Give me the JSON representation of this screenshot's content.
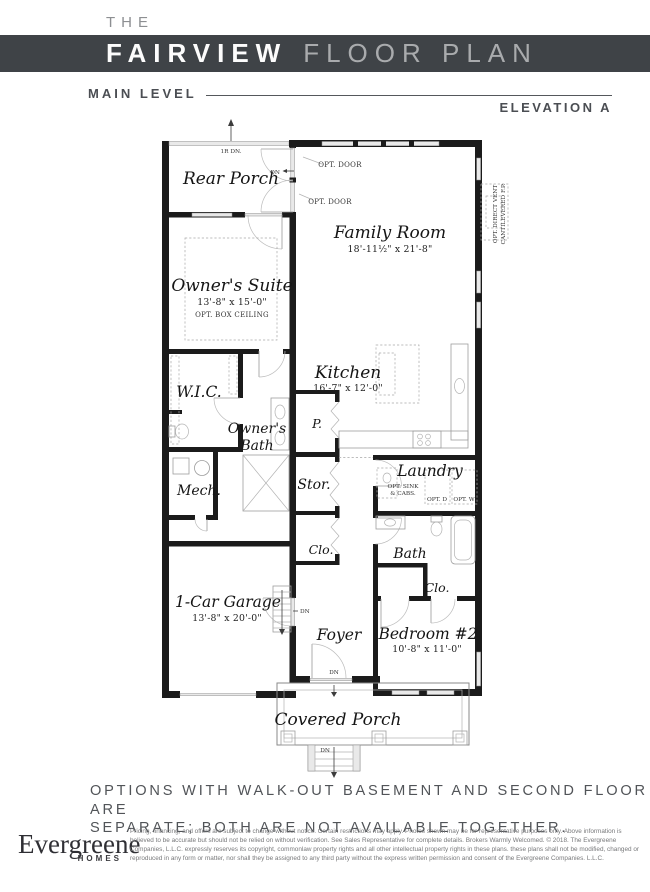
{
  "header": {
    "pre_title": "THE",
    "title": "FAIRVIEW",
    "title_suffix": "FLOOR PLAN",
    "level_label": "MAIN LEVEL",
    "elevation_label": "ELEVATION A"
  },
  "plan": {
    "labels": {
      "rear_porch": "Rear Porch",
      "family_room": "Family Room",
      "family_room_dims": "18'-11½\" x 21'-8\"",
      "owners_suite": "Owner's Suite",
      "owners_suite_dims": "13'-8\" x 15'-0\"",
      "owners_suite_note": "OPT. BOX CEILING",
      "wic": "W.I.C.",
      "kitchen": "Kitchen",
      "kitchen_dims": "16'-7\" x 12'-0\"",
      "owners_bath_1": "Owner's",
      "owners_bath_2": "Bath",
      "pantry": "P.",
      "storage": "Stor.",
      "mech": "Mech.",
      "laundry": "Laundry",
      "laundry_opt_1": "OPT. SINK",
      "laundry_opt_2": "& CABS.",
      "opt_dryer": "OPT. D",
      "opt_washer": "OPT. W",
      "closet_hall": "Clo.",
      "bath": "Bath",
      "closet_bedroom": "Clo.",
      "garage": "1-Car Garage",
      "garage_dims": "13'-8\" x 20'-0\"",
      "foyer": "Foyer",
      "bedroom2": "Bedroom #2",
      "bedroom2_dims": "10'-8\" x 11'-0\"",
      "covered_porch": "Covered Porch",
      "opt_door": "OPT. DOOR",
      "fireplace_1": "OPT. DIRECT VENT",
      "fireplace_2": "CANTILEVERED F.P.",
      "rear_steps": "1R DN.",
      "dn": "DN"
    }
  },
  "note": {
    "line1": "OPTIONS WITH WALK-OUT BASEMENT AND SECOND FLOOR ARE",
    "line2": "SEPARATE; BOTH ARE NOT AVAILABLE TOGETHER."
  },
  "footer": {
    "brand_name": "Evergreene",
    "brand_sub": "HOMES",
    "disclaimer": "Pricing, financing, and offers are subject to change without notice. Certain restrictions may apply. Photos shown may be for representative purposes only. Above information is believed to be accurate but should not be relied on without verification. See Sales Representative for complete details. Brokers Warmly Welcomed. © 2018. The Evergreene Companies, L.L.C. expressly reserves its copyright, commonlaw property rights and all other intellectual property rights in these plans. these plans shall not be modified, changed or reproduced in any form or matter, nor shall they be assigned to any third party without the express written permission and consent of the Evergreene Companies. L.L.C."
  },
  "colors": {
    "header_bar": "#3f4347",
    "wall": "#1b1b1b",
    "note_text": "#515458"
  }
}
